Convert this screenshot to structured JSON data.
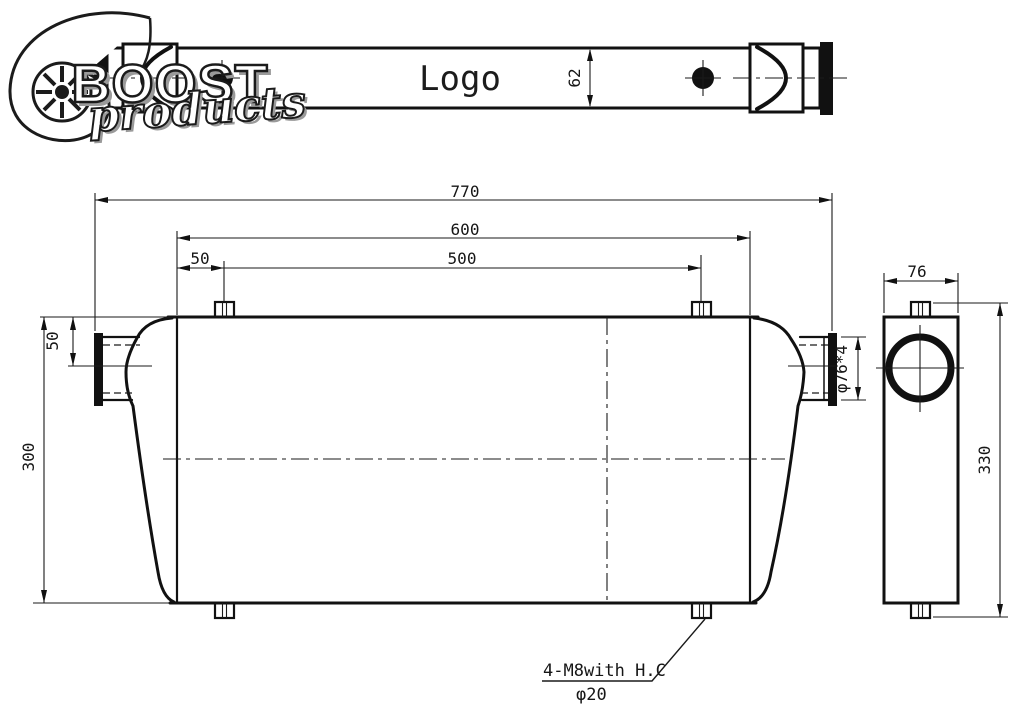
{
  "watermark": {
    "word1": "BOOST",
    "word2": "products"
  },
  "top_view": {
    "logo_text": "Logo",
    "height_dim": "62"
  },
  "front_view": {
    "overall_width": "770",
    "inner_width": "600",
    "bracket_span": "500",
    "bracket_offset": "50",
    "port_offset": "50",
    "height": "300",
    "port_spec": "φ76*4",
    "note1": "4-M8with H.C",
    "note2": "φ20"
  },
  "side_view": {
    "depth": "76",
    "height": "330"
  }
}
